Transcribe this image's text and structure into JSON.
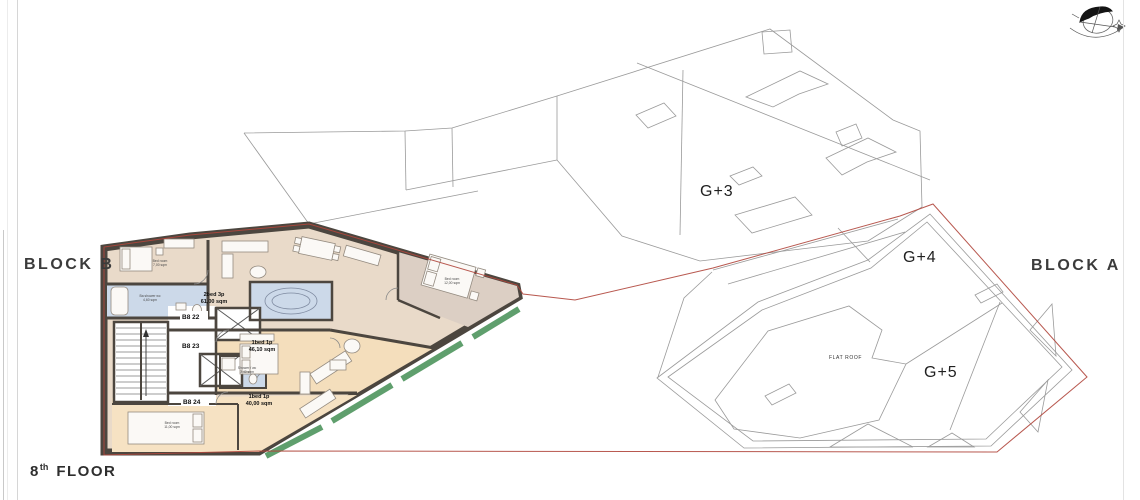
{
  "page": {
    "background": "#ffffff",
    "sheet_edge_color": "#d6d6d6"
  },
  "titles": {
    "block_b_label": "BLOCK B",
    "block_a_label": "BLOCK A"
  },
  "floor_title": {
    "number": "8",
    "ordinal": "th",
    "word": "FLOOR"
  },
  "icons": {
    "north_arrow": "north-arrow-with-sun-path"
  },
  "colors": {
    "site_boundary_red": "#b0463c",
    "balcony_edge_green": "#5f9f6d",
    "wall_dark": "#4c463f",
    "roofline_gray": "#9a9a9a",
    "floor_beige": "#e9dac9",
    "floor_tan": "#f4debc",
    "bath_blue": "#ccd9e9",
    "bedroom_taupe": "#dccfc4"
  },
  "block_a": {
    "levels": [
      {
        "label": "G+3"
      },
      {
        "label": "G+4"
      },
      {
        "label": "G+5"
      }
    ],
    "flat_roof_label": "FLAT ROOF"
  },
  "block_b": {
    "units": [
      {
        "id": "B8 22",
        "type": "2bed 3p",
        "area": "61,00 sqm"
      },
      {
        "id": "B8 23",
        "type": "1bed 1p",
        "area": "46,10 sqm"
      },
      {
        "id": "B8 24",
        "type": "1bed 1p",
        "area": "40,00 sqm"
      }
    ],
    "rooms": [
      {
        "name": "Bed room",
        "area": "7,00 sqm"
      },
      {
        "name": "Ba shower wc",
        "area": "4,60 sqm"
      },
      {
        "name": "Shower / wc",
        "area": "3,40 sqm"
      },
      {
        "name": "Bed room",
        "area": "11,00 sqm"
      },
      {
        "name": "Bed room",
        "area": "12,00 sqm"
      }
    ]
  }
}
